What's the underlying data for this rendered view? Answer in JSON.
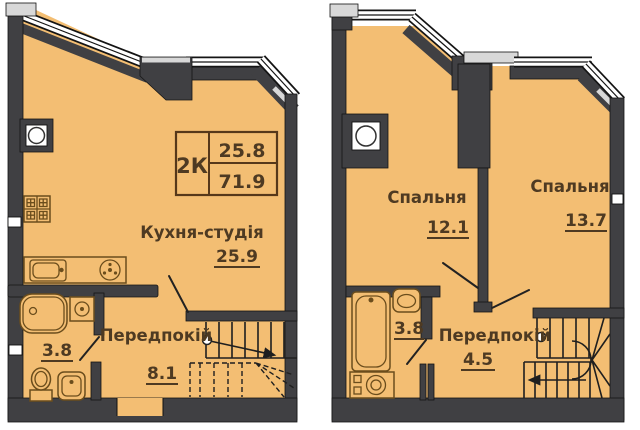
{
  "colors": {
    "floor": "#f3be73",
    "wall": "#404043",
    "window": "#ffffff",
    "cap": "#d8d8d8",
    "fixture": "#6b4d1c",
    "text": "#4e3a22",
    "line": "#1f1f1f"
  },
  "info_box": {
    "apartment_type": "2К",
    "upper_value": "25.8",
    "lower_value": "71.9"
  },
  "plans": [
    {
      "id": "level-1",
      "rooms": [
        {
          "key": "kitchen-studio",
          "label": "Кухня-студія",
          "area": "25.9"
        },
        {
          "key": "hallway",
          "label": "Передпокій",
          "area": "8.1"
        },
        {
          "key": "bathroom",
          "area": "3.8"
        }
      ]
    },
    {
      "id": "level-2",
      "rooms": [
        {
          "key": "bedroom-1",
          "label": "Спальня",
          "area": "12.1"
        },
        {
          "key": "bedroom-2",
          "label": "Спальня",
          "area": "13.7"
        },
        {
          "key": "hallway",
          "label": "Передпокій",
          "area": "4.5"
        },
        {
          "key": "bathroom",
          "area": "3.8"
        }
      ]
    }
  ]
}
